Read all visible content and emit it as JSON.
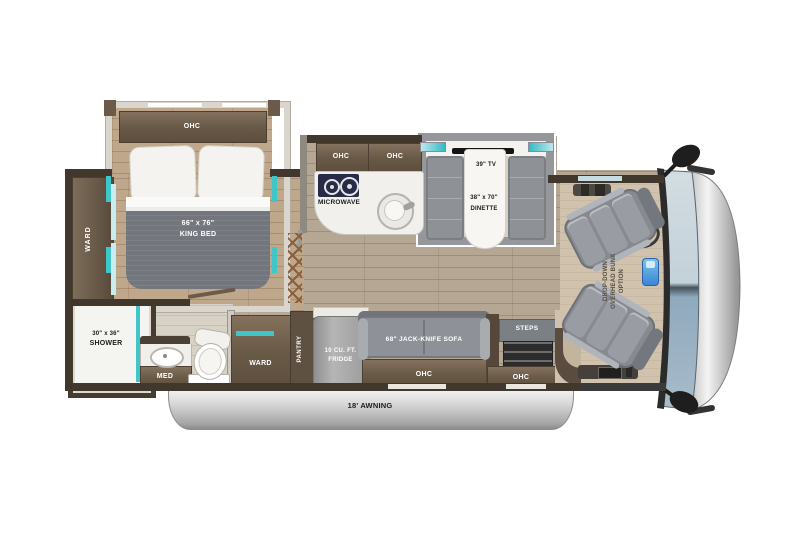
{
  "floorplan": {
    "bedroom": {
      "ohc": "OHC",
      "bed_size": "66\" x 76\"",
      "bed_name": "KING BED",
      "ward": "WARD"
    },
    "bathroom": {
      "shower_size": "30\" x 36\"",
      "shower": "SHOWER",
      "med": "MED"
    },
    "kitchen": {
      "ohc_left": "OHC",
      "ohc_right": "OHC",
      "microwave": "MICROWAVE"
    },
    "dinette": {
      "tv": "39\" TV",
      "size": "38\" x 70\"",
      "name": "DINETTE"
    },
    "living": {
      "ward": "WARD",
      "pantry": "PANTRY",
      "fridge_line1": "10 CU. FT.",
      "fridge_line2": "FRIDGE",
      "sofa": "68\" JACK-KNIFE SOFA",
      "sofa_ohc": "OHC",
      "steps": "STEPS",
      "entry_ohc": "OHC"
    },
    "cab": {
      "bunk_line1": "DROP-DOWN",
      "bunk_line2": "OVERHEAD BUNK",
      "bunk_line3": "OPTION"
    },
    "exterior": {
      "awning": "18' AWNING"
    },
    "colors": {
      "wall": "#41372c",
      "cabinet_brown": "#6b5b49",
      "floor_main": "#b6a694",
      "floor_bedroom": "#bfa78b",
      "cab_floor": "#d0c2ad",
      "teal_accent": "#3fc6c9",
      "seat_gray": "#8a8d94",
      "duvet_gray": "#73767c",
      "windshield_upper": "#c9d5dc",
      "windshield_lower": "#8fa9bd",
      "awning_silver": "#b9b9b9"
    }
  }
}
